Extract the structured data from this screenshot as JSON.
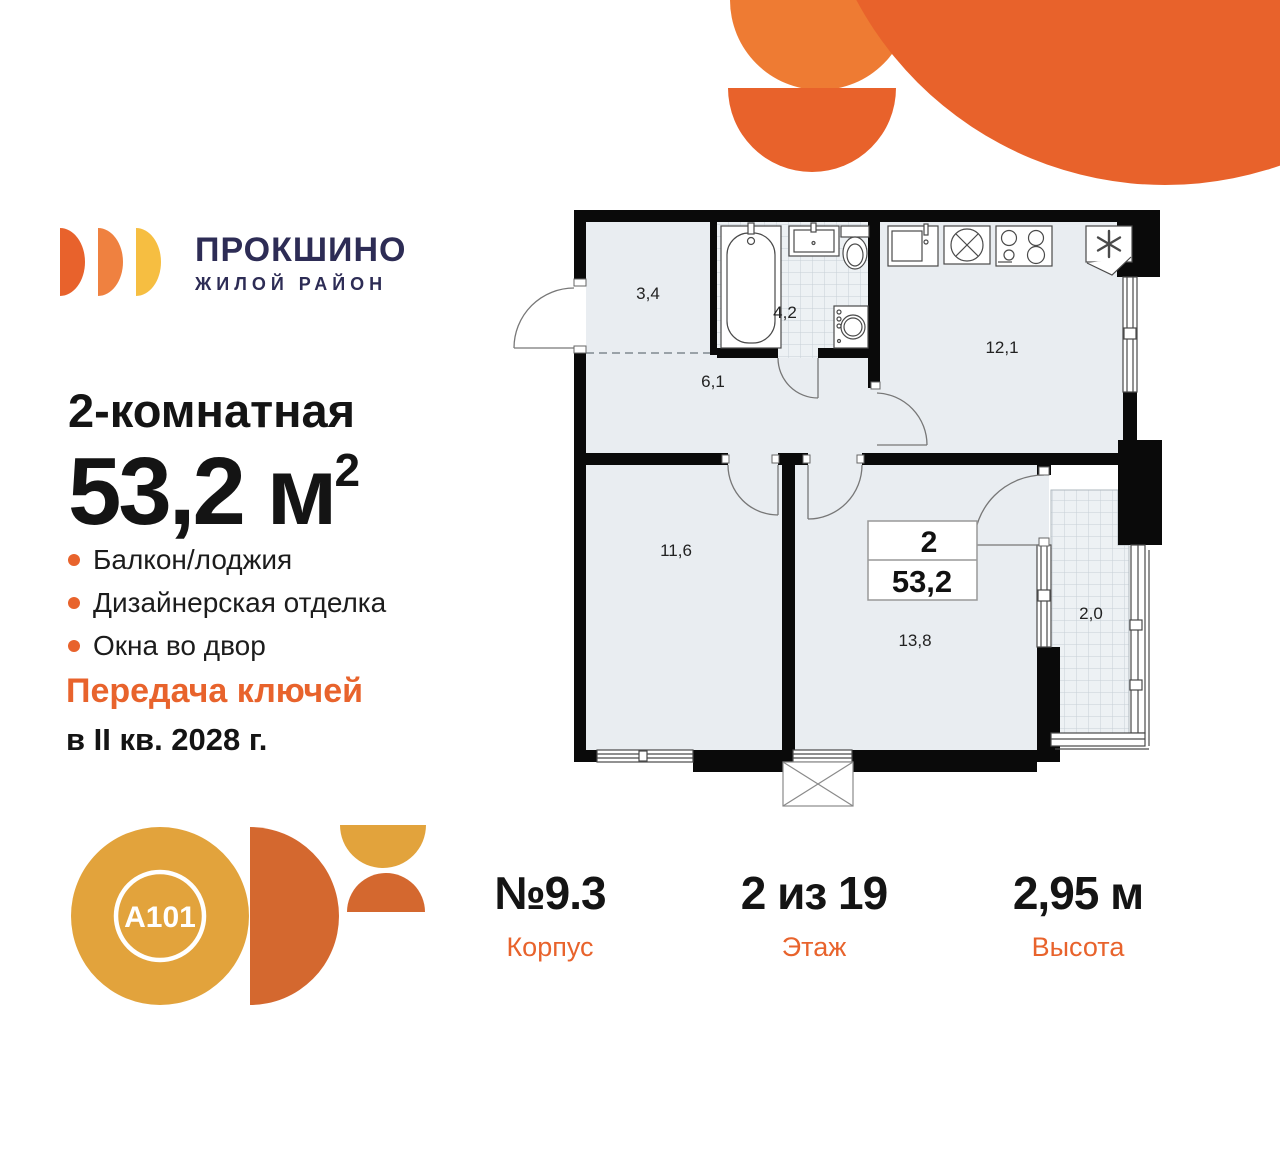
{
  "brand": {
    "title": "ПРОКШИНО",
    "subtitle": "ЖИЛОЙ РАЙОН"
  },
  "listing": {
    "rooms_label": "2-комнатная",
    "area_value": "53,2",
    "area_unit": " м",
    "area_sup": "2",
    "features": [
      {
        "label": "Балкон/лоджия"
      },
      {
        "label": "Дизайнерская отделка"
      },
      {
        "label": "Окна во двор"
      }
    ],
    "handover_line1": "Передача ключей",
    "handover_line2": "в II кв. 2028 г."
  },
  "plan": {
    "rooms": [
      {
        "name": "wardrobe",
        "area": "3,4"
      },
      {
        "name": "bathroom",
        "area": "4,2"
      },
      {
        "name": "hallway",
        "area": "6,1"
      },
      {
        "name": "kitchen",
        "area": "12,1"
      },
      {
        "name": "bedroom",
        "area": "11,6"
      },
      {
        "name": "living",
        "area": "13,8"
      },
      {
        "name": "balcony",
        "area": "2,0"
      }
    ],
    "label_box": {
      "rooms": "2",
      "area": "53,2"
    }
  },
  "info": [
    {
      "value": "№9.3",
      "label": "Корпус"
    },
    {
      "value": "2 из 19",
      "label": "Этаж"
    },
    {
      "value": "2,95 м",
      "label": "Высота"
    }
  ],
  "developer": {
    "logo_text": "A101"
  },
  "colors": {
    "accent_orange": "#E8632C",
    "deco_orange": "#E8622B",
    "deco_light_orange": "#EE7B33",
    "logo_mid_orange": "#EF8140",
    "logo_yellow": "#F6BE41",
    "a101_amber": "#E2A33C",
    "a101_dark_orange": "#D4682F",
    "brand_navy": "#2D2C55",
    "floor_fill": "#E9EDF1",
    "wall_black": "#0A0A0A"
  }
}
